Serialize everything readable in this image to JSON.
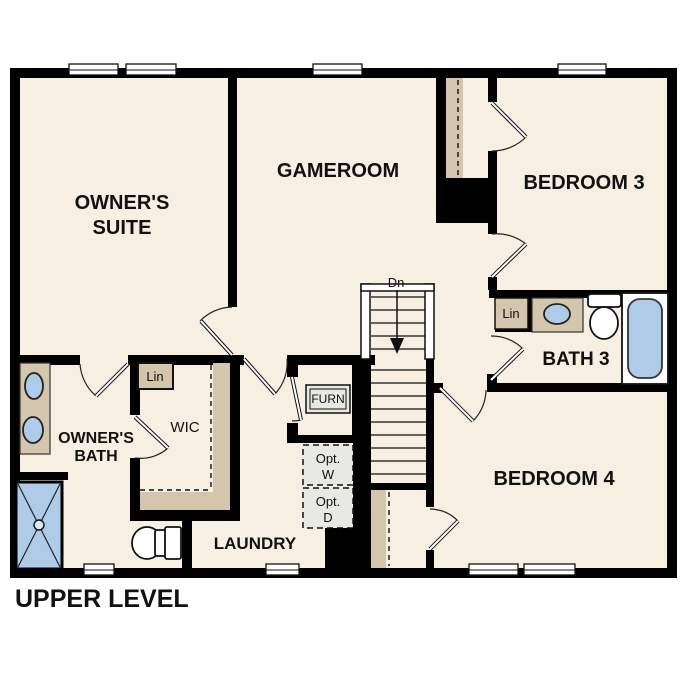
{
  "plan": {
    "title": "UPPER LEVEL"
  },
  "rooms": {
    "owners_suite": {
      "line1": "OWNER'S",
      "line2": "SUITE"
    },
    "gameroom": {
      "label": "GAMEROOM"
    },
    "bedroom3": {
      "label": "BEDROOM 3"
    },
    "bath3": {
      "label": "BATH 3"
    },
    "bedroom4": {
      "label": "BEDROOM 4"
    },
    "owners_bath": {
      "line1": "OWNER'S",
      "line2": "BATH"
    },
    "wic": {
      "label": "WIC"
    },
    "laundry": {
      "label": "LAUNDRY"
    }
  },
  "features": {
    "stairs": {
      "direction_label": "Dn"
    },
    "linen_hall": {
      "label": "Lin"
    },
    "linen_bath3": {
      "label": "Lin"
    },
    "furnace": {
      "label": "FURN"
    },
    "optional_washer": {
      "line1": "Opt.",
      "line2": "W"
    },
    "optional_dryer": {
      "line1": "Opt.",
      "line2": "D"
    }
  },
  "colors": {
    "background": "#ffffff",
    "floor": "#f6efe2",
    "wall": "#000000",
    "casework_tan": "#d3c6ad",
    "fixture_blue": "#aecbe8",
    "appliance_gray": "#e8e8e5"
  }
}
